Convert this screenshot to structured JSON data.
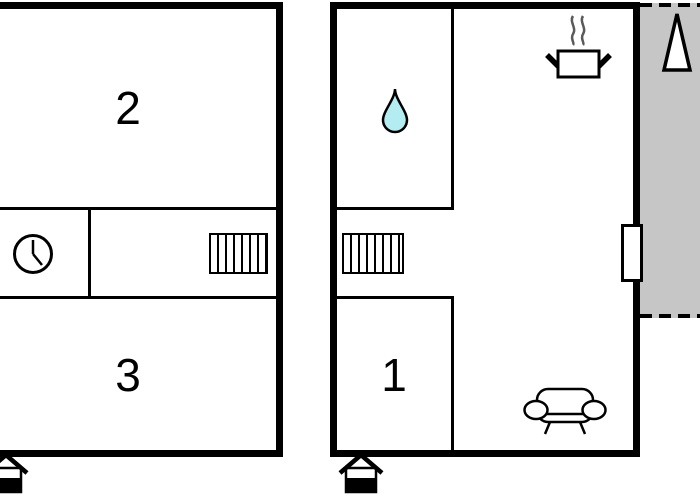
{
  "title": "Two-unit floor plan",
  "canvas": {
    "width": 700,
    "height": 500,
    "background_color": "#ffffff"
  },
  "colors": {
    "wall": "#000000",
    "terrace_fill": "#c6c6c6",
    "water_drop_fill": "#b3edf2",
    "steam_stroke": "#5a5a5a"
  },
  "units": {
    "left": {
      "rooms": [
        {
          "label": "2"
        },
        {
          "label": "3"
        }
      ],
      "icons": {
        "clock": "clock-icon",
        "stairs": "stairs-icon",
        "entrance": "entrance-icon"
      }
    },
    "right": {
      "rooms": [
        {
          "label": "1"
        }
      ],
      "icons": {
        "water_drop": "water-drop-icon",
        "cooking_pot": "cooking-pot-icon",
        "steam": "steam-icon",
        "stairs": "stairs-icon",
        "sofa": "sofa-icon",
        "door": "door-icon",
        "entrance": "entrance-icon",
        "north_arrow": "north-arrow-icon"
      }
    }
  }
}
